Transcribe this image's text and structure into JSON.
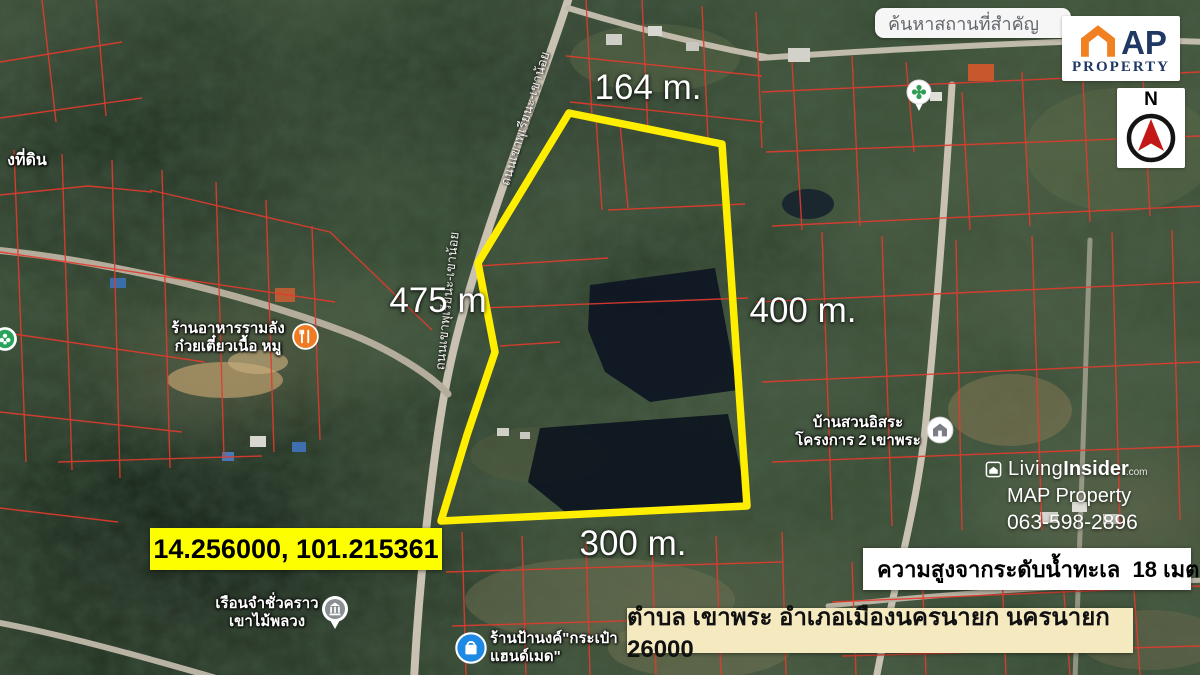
{
  "search": {
    "text": "ค้นหาสถานที่สำคัญ"
  },
  "logo": {
    "ap": "AP",
    "property": "PROPERTY"
  },
  "compass": {
    "n": "N"
  },
  "dimensions": {
    "top": "164 m.",
    "left": "475 m",
    "right": "400 m.",
    "bottom": "300 m."
  },
  "property": {
    "outline_points": "569,113 722,144 747,506 441,521 467,435 495,352 478,263",
    "coordinates": "14.256000, 101.215361",
    "elevation": "ความสูงจากระดับน้ำทะเล  18 เมตร",
    "address": "ตำบล เขาพระ อำเภอเมืองนครนายก นครนายก 26000"
  },
  "watermark": {
    "living": "Living",
    "insider": "Insider",
    "tld": ".com",
    "name": "MAP Property",
    "phone": "063-598-2896"
  },
  "pois": {
    "road_name": "ถนนเขาพุเรียนะ-เขาน้อย",
    "land_office": "งที่ดิน",
    "restaurant1": "ร้านอาหารรามลัง",
    "restaurant2": "ก๋วยเตี๋ยวเนื้อ หมู",
    "homestay1": "บ้านสวนอิสระ",
    "homestay2": "โครงการ 2 เขาพระ",
    "prison1": "เรือนจำชั่วคราว",
    "prison2": "เขาไม้พลวง",
    "shop1": "ร้านป้านงค์\"กระเป๋า",
    "shop2": "แฮนด์เมด\""
  }
}
